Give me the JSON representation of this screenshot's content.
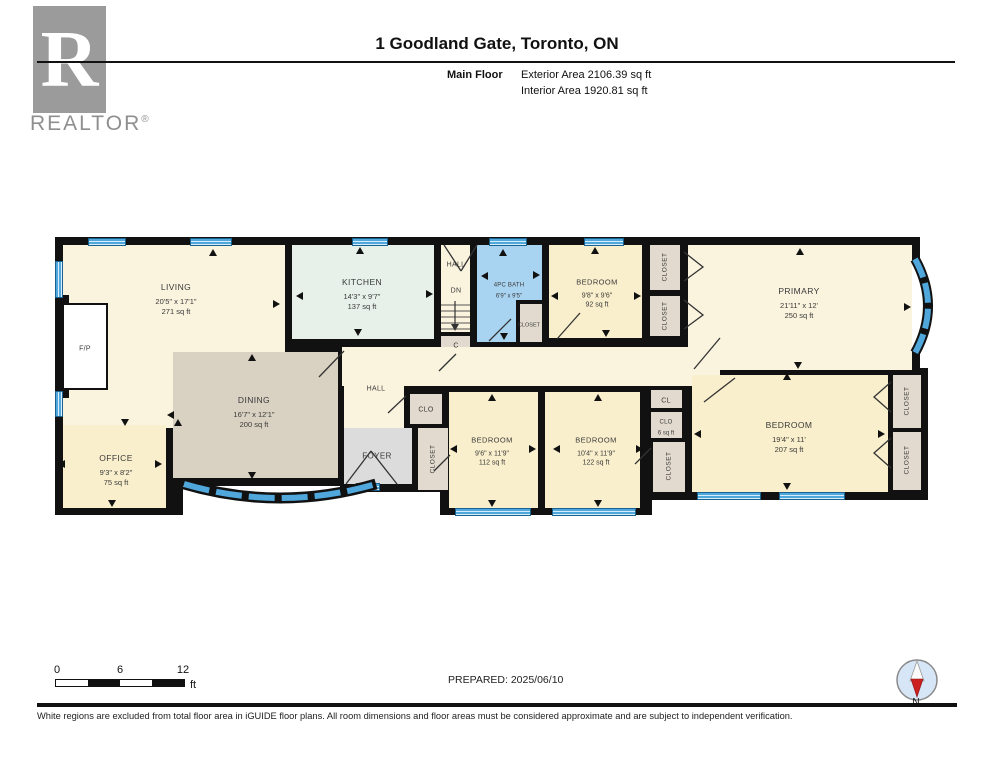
{
  "header": {
    "logo_letter": "R",
    "brand": "REALTOR",
    "registered": "®",
    "title": "1 Goodland Gate, Toronto, ON",
    "floor_label": "Main Floor",
    "exterior_area": "Exterior Area 2106.39 sq ft",
    "interior_area": "Interior Area 1920.81 sq ft"
  },
  "rooms": {
    "living": {
      "name": "LIVING",
      "dims": "20'5\" x 17'1\"",
      "area": "271 sq ft"
    },
    "office": {
      "name": "OFFICE",
      "dims": "9'3\" x 8'2\"",
      "area": "75 sq ft"
    },
    "dining": {
      "name": "DINING",
      "dims": "16'7\" x 12'1\"",
      "area": "200 sq ft"
    },
    "kitchen": {
      "name": "KITCHEN",
      "dims": "14'3\" x 9'7\"",
      "area": "137 sq ft"
    },
    "hall_top": {
      "name": "HALL"
    },
    "dn": {
      "name": "DN"
    },
    "closet_c": {
      "name": "C"
    },
    "bath": {
      "name": "4PC BATH",
      "dims": "6'9\" x 9'5\""
    },
    "closet_bath": {
      "name": "CLOSET"
    },
    "bedroom_top": {
      "name": "BEDROOM",
      "dims": "9'8\" x 9'6\"",
      "area": "92 sq ft"
    },
    "closet_t1": {
      "name": "CLOSET"
    },
    "closet_t2": {
      "name": "CLOSET"
    },
    "primary": {
      "name": "PRIMARY",
      "dims": "21'11\" x 12'",
      "area": "250 sq ft"
    },
    "hall_main": {
      "name": "HALL"
    },
    "foyer": {
      "name": "FOYER"
    },
    "clo_hall": {
      "name": "CLO"
    },
    "closet_foyer": {
      "name": "CLOSET"
    },
    "bedroom_b1": {
      "name": "BEDROOM",
      "dims": "9'6\" x 11'9\"",
      "area": "112 sq ft"
    },
    "bedroom_b2": {
      "name": "BEDROOM",
      "dims": "10'4\" x 11'9\"",
      "area": "122 sq ft"
    },
    "cl": {
      "name": "CL"
    },
    "clo6": {
      "name": "CLO",
      "area": "6 sq ft"
    },
    "closet_mid": {
      "name": "CLOSET"
    },
    "bedroom_right": {
      "name": "BEDROOM",
      "dims": "19'4\" x 11'",
      "area": "207 sq ft"
    },
    "closet_r1": {
      "name": "CLOSET"
    },
    "closet_r2": {
      "name": "CLOSET"
    },
    "fireplace": {
      "name": "F/P"
    }
  },
  "footer": {
    "scale": {
      "tick0": "0",
      "tick1": "6",
      "tick2": "12",
      "unit": "ft"
    },
    "prepared": "PREPARED: 2025/06/10",
    "compass": "N",
    "disclaimer": "White regions are excluded from total floor area in iGUIDE floor plans. All room dimensions and floor areas must be considered approximate and are subject to independent verification."
  },
  "colors": {
    "wall": "#111111",
    "window_blue": "#4FA7DC",
    "bath_blue": "#A9D4F1",
    "kitchen_mint": "#E7F0E9",
    "dining_tan": "#D9D1C1",
    "foyer_gray": "#DCDCDC",
    "closet_beige": "#E2DACE",
    "room_cream": "#FAF3DE",
    "room_yellow": "#FAEFCC"
  }
}
